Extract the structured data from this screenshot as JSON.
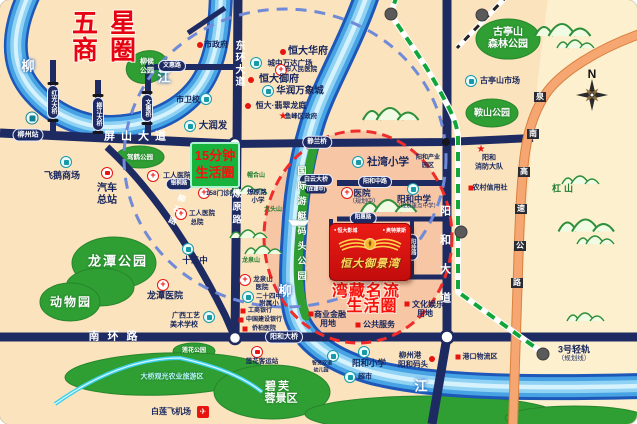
{
  "canvas": {
    "width": 637,
    "height": 424
  },
  "colors": {
    "land": "#fbe3bd",
    "land_east": "#fdf0cf",
    "vip_zone_pink": "#f2ae92",
    "road_navy": "#1e2b63",
    "river_blue": "#47a3e3",
    "park_green": "#2f9e33",
    "highway_orange": "#f5a671",
    "planned_rail_green": "#12a53a",
    "circle_15min_blue": "#6f8ad8",
    "circle_vip_red": "#ef2b2b",
    "accent_red": "#e8140e",
    "gold": "#ffd24a"
  },
  "badges": {
    "life15": {
      "line1": "15分钟",
      "line2": "生活圈"
    },
    "project": {
      "tag_left": "恒大影城",
      "tag_right": "奥特莱斯",
      "name": "恒大御景湾"
    }
  },
  "labels": [
    {
      "id": "biz-circle-title-line1",
      "t": "五星",
      "x": 104,
      "y": 23,
      "c": "title-red"
    },
    {
      "id": "biz-circle-title-line2",
      "t": "商圈",
      "x": 104,
      "y": 50,
      "c": "title-red"
    },
    {
      "id": "river-name-liu-west",
      "t": "柳",
      "x": 28,
      "y": 66,
      "c": "river-ch"
    },
    {
      "id": "river-name-jiang-west",
      "t": "江",
      "x": 164,
      "y": 77,
      "c": "river-ch"
    },
    {
      "id": "river-name-liu-east",
      "t": "柳",
      "x": 285,
      "y": 291,
      "c": "river-ch"
    },
    {
      "id": "river-name-jiang-east",
      "t": "江",
      "x": 421,
      "y": 386,
      "c": "river-ch"
    },
    {
      "id": "city-gov-dot-icon",
      "t": "",
      "x": 200,
      "y": 45,
      "c": "ico-rdot"
    },
    {
      "id": "city-gov",
      "t": "市政府",
      "x": 216,
      "y": 45,
      "c": "poi"
    },
    {
      "id": "wenhui-road-pill",
      "t": "文惠路",
      "x": 172,
      "y": 66,
      "c": "pill",
      "fs": 6
    },
    {
      "id": "liuhou-park-line1",
      "t": "柳侯",
      "x": 147,
      "y": 62,
      "c": "park-ch",
      "fs": 7
    },
    {
      "id": "liuhou-park-line2",
      "t": "公园",
      "x": 147,
      "y": 71,
      "c": "park-ch",
      "fs": 7
    },
    {
      "id": "hongguang-bridge-pill",
      "t": "红光大桥",
      "x": 53,
      "y": 102,
      "c": "pill v bridge",
      "fs": 6
    },
    {
      "id": "liujiang-bridge-pill",
      "t": "柳江大桥",
      "x": 98,
      "y": 114,
      "c": "pill v bridge",
      "fs": 6
    },
    {
      "id": "wenhui-bridge-pill",
      "t": "文惠桥",
      "x": 147,
      "y": 108,
      "c": "pill v bridge",
      "fs": 6
    },
    {
      "id": "health-school",
      "t": "市卫校",
      "x": 188,
      "y": 100,
      "c": "poi"
    },
    {
      "id": "health-school-icon",
      "t": "",
      "x": 206,
      "y": 99,
      "c": "ico-sch"
    },
    {
      "id": "darunfa-icon",
      "t": "",
      "x": 190,
      "y": 126,
      "c": "ico-sch"
    },
    {
      "id": "darunfa",
      "t": "大润发",
      "x": 213,
      "y": 126,
      "c": "poi",
      "fs": 9.5
    },
    {
      "id": "pingshan-avenue",
      "t": "屏山大道",
      "x": 138,
      "y": 137,
      "c": "road-ch",
      "ls": 6
    },
    {
      "id": "donghuan-avenue",
      "t": "东环大道",
      "x": 238,
      "y": 64,
      "c": "road-ch v",
      "fs": 10,
      "ls": 2
    },
    {
      "id": "train-station-icon",
      "t": "",
      "x": 32,
      "y": 118,
      "c": "ico-train"
    },
    {
      "id": "liuzhou-station-pill",
      "t": "柳州站",
      "x": 28,
      "y": 135,
      "c": "pill",
      "fs": 7
    },
    {
      "id": "hengda-huafu-dot-icon",
      "t": "",
      "x": 283,
      "y": 52,
      "c": "ico-rdot"
    },
    {
      "id": "hengda-huafu",
      "t": "恒大华府",
      "x": 308,
      "y": 52,
      "c": "poi",
      "fs": 10
    },
    {
      "id": "wanda-plaza-icon",
      "t": "",
      "x": 256,
      "y": 63,
      "c": "ico-sch"
    },
    {
      "id": "wanda-plaza",
      "t": "城中万达广场",
      "x": 290,
      "y": 63,
      "c": "poi",
      "fs": 7.5
    },
    {
      "id": "renmin-hospital-icon",
      "t": "+",
      "x": 281,
      "y": 70,
      "c": "ico-cross"
    },
    {
      "id": "renmin-hospital",
      "t": "市人民医院",
      "x": 301,
      "y": 70,
      "c": "poi",
      "fs": 6.5
    },
    {
      "id": "hengda-yufu-dot-icon",
      "t": "",
      "x": 251,
      "y": 80,
      "c": "ico-rdot"
    },
    {
      "id": "hengda-yufu",
      "t": "恒大御府",
      "x": 279,
      "y": 80,
      "c": "poi",
      "fs": 10
    },
    {
      "id": "mixc-icon",
      "t": "",
      "x": 268,
      "y": 91,
      "c": "ico-sch"
    },
    {
      "id": "mixc",
      "t": "华润万象城",
      "x": 300,
      "y": 91,
      "c": "poi",
      "fs": 9.5
    },
    {
      "id": "hengda-feicui-dot-icon",
      "t": "",
      "x": 248,
      "y": 106,
      "c": "ico-rdot"
    },
    {
      "id": "hengda-feicui",
      "t": "恒大·翡翠龙庭",
      "x": 281,
      "y": 106,
      "c": "poi"
    },
    {
      "id": "yufeng-gov-star-icon",
      "t": "★",
      "x": 283,
      "y": 117,
      "c": "ico-star"
    },
    {
      "id": "yufeng-gov",
      "t": "鱼峰区政府",
      "x": 301,
      "y": 117,
      "c": "poi",
      "fs": 6.5
    },
    {
      "id": "jiahe-park",
      "t": "驾鹤公园",
      "x": 140,
      "y": 158,
      "c": "park-ch",
      "fs": 6.5
    },
    {
      "id": "feie-mall-icon",
      "t": "",
      "x": 66,
      "y": 162,
      "c": "ico-sch"
    },
    {
      "id": "feie-mall",
      "t": "飞鹅商场",
      "x": 62,
      "y": 176,
      "c": "poi",
      "fs": 9
    },
    {
      "id": "bus-terminal-icon",
      "t": "",
      "x": 107,
      "y": 173,
      "c": "ico-bus"
    },
    {
      "id": "bus-terminal-line1",
      "t": "汽车",
      "x": 107,
      "y": 189,
      "c": "poi",
      "fs": 10
    },
    {
      "id": "bus-terminal-line2",
      "t": "总站",
      "x": 107,
      "y": 201,
      "c": "poi",
      "fs": 10
    },
    {
      "id": "worker-hospital-icon",
      "t": "+",
      "x": 153,
      "y": 176,
      "c": "ico-cross"
    },
    {
      "id": "worker-hospital",
      "t": "工人医院",
      "x": 177,
      "y": 176,
      "c": "poi",
      "fs": 7
    },
    {
      "id": "yintong-road-pill",
      "t": "银桐路",
      "x": 179,
      "y": 184,
      "c": "pill",
      "fs": 5.5
    },
    {
      "id": "clinic158-icon",
      "t": "+",
      "x": 204,
      "y": 193,
      "c": "ico-cross"
    },
    {
      "id": "clinic158",
      "t": "158门诊部",
      "x": 221,
      "y": 194,
      "c": "poi",
      "fs": 6.5
    },
    {
      "id": "worker-hospital-hq-icon",
      "t": "+",
      "x": 181,
      "y": 214,
      "c": "ico-cross"
    },
    {
      "id": "worker-hospital-hq-line1",
      "t": "工人医院",
      "x": 202,
      "y": 214,
      "c": "poi",
      "fs": 6.5
    },
    {
      "id": "worker-hospital-hq-line2",
      "t": "总院",
      "x": 197,
      "y": 223,
      "c": "poi",
      "fs": 6.5
    },
    {
      "id": "liaoyuan-road",
      "t": "燎原路",
      "x": 236,
      "y": 208,
      "c": "road-ch v",
      "fs": 9,
      "ls": 4
    },
    {
      "id": "liushi-road",
      "t": "柳石路",
      "x": 176,
      "y": 211,
      "c": "road-ch v",
      "fs": 8,
      "ls": 4,
      "r": 22
    },
    {
      "id": "liaoyuan-primary-line1",
      "t": "燎原路",
      "x": 257,
      "y": 193,
      "c": "poi",
      "fs": 6.5
    },
    {
      "id": "liaoyuan-primary-line2",
      "t": "小学",
      "x": 258,
      "y": 201,
      "c": "poi",
      "fs": 6.5
    },
    {
      "id": "maohe-hill",
      "t": "帽合山",
      "x": 256,
      "y": 176,
      "c": "mtn-ch",
      "fs": 6
    },
    {
      "id": "jiutou-hill",
      "t": "九头山",
      "x": 273,
      "y": 210,
      "c": "mtn-ch",
      "fs": 6
    },
    {
      "id": "jinglan-bridge-pill",
      "t": "静兰桥",
      "x": 317,
      "y": 142,
      "c": "pill",
      "fs": 6.5
    },
    {
      "id": "shewan-primary-icon",
      "t": "",
      "x": 358,
      "y": 162,
      "c": "ico-sch"
    },
    {
      "id": "shewan-primary",
      "t": "社湾小学",
      "x": 388,
      "y": 162,
      "c": "poi",
      "fs": 10.5
    },
    {
      "id": "yanghe-industry-line1",
      "t": "阳和产业",
      "x": 428,
      "y": 158,
      "c": "poi",
      "fs": 6
    },
    {
      "id": "yanghe-industry-line2",
      "t": "园区",
      "x": 428,
      "y": 166,
      "c": "poi",
      "fs": 6
    },
    {
      "id": "baiyun-bridge-pill",
      "t": "白云大桥",
      "x": 316,
      "y": 180,
      "c": "pill",
      "fs": 6
    },
    {
      "id": "baiyun-bridge-note",
      "t": "(在建中)",
      "x": 316,
      "y": 190,
      "c": "pill-sub"
    },
    {
      "id": "yanghe-mid-road-pill",
      "t": "阳和中路",
      "x": 375,
      "y": 182,
      "c": "pill",
      "fs": 6
    },
    {
      "id": "planned-hospital-icon",
      "t": "+",
      "x": 347,
      "y": 193,
      "c": "ico-cross"
    },
    {
      "id": "planned-hospital",
      "t": "医院",
      "x": 362,
      "y": 193,
      "c": "poi",
      "fs": 8.5
    },
    {
      "id": "planned-hospital-note",
      "t": "（规划中）",
      "x": 364,
      "y": 202,
      "c": "poi-sub"
    },
    {
      "id": "yanghe-middle-school-icon",
      "t": "",
      "x": 413,
      "y": 189,
      "c": "ico-sch"
    },
    {
      "id": "yanghe-middle-school",
      "t": "阳和中学",
      "x": 414,
      "y": 199,
      "c": "poi",
      "fs": 8.5
    },
    {
      "id": "yanghe-middle-school-note",
      "t": "（规划重点中学）",
      "x": 417,
      "y": 207,
      "c": "poi-sub",
      "fs": 5.5
    },
    {
      "id": "yacht-quay-park",
      "t": "国际游艇码头公园",
      "x": 301,
      "y": 226,
      "c": "quay-ch v",
      "ls": 6
    },
    {
      "id": "yanghe-avenue",
      "t": "阳和大道",
      "x": 444,
      "y": 263,
      "c": "road-ch v",
      "ls": 18
    },
    {
      "id": "fire-brigade-star-icon",
      "t": "★",
      "x": 481,
      "y": 150,
      "c": "ico-star"
    },
    {
      "id": "fire-brigade-line1",
      "t": "阳和",
      "x": 489,
      "y": 158,
      "c": "poi",
      "fs": 7
    },
    {
      "id": "fire-brigade-line2",
      "t": "消防大队",
      "x": 489,
      "y": 167,
      "c": "poi",
      "fs": 7
    },
    {
      "id": "rural-credit-sq-icon",
      "t": "",
      "x": 471,
      "y": 188,
      "c": "ico-rsq"
    },
    {
      "id": "rural-credit",
      "t": "农村信用社",
      "x": 490,
      "y": 188,
      "c": "poi",
      "fs": 7
    },
    {
      "id": "gutingshan-forest-line1",
      "t": "古亭山",
      "x": 508,
      "y": 33,
      "c": "park-ch",
      "fs": 10
    },
    {
      "id": "gutingshan-forest-line2",
      "t": "森林公园",
      "x": 508,
      "y": 45,
      "c": "park-ch",
      "fs": 10
    },
    {
      "id": "gutingshan-market-icon",
      "t": "",
      "x": 471,
      "y": 81,
      "c": "ico-sch"
    },
    {
      "id": "gutingshan-market",
      "t": "古亭山市场",
      "x": 500,
      "y": 81,
      "c": "poi"
    },
    {
      "id": "anshan-park",
      "t": "鞍山公园",
      "x": 492,
      "y": 113,
      "c": "park-ch",
      "fs": 9
    },
    {
      "id": "compass-n-label",
      "t": "N",
      "x": 592,
      "y": 74,
      "c": "compass-n"
    },
    {
      "id": "gangshan-hill",
      "t": "杠山",
      "x": 564,
      "y": 189,
      "c": "mtn-ch",
      "fs": 9,
      "ls": 3
    },
    {
      "id": "expressway-ch-1",
      "t": "泉",
      "x": 540,
      "y": 97,
      "c": "hwy-ch"
    },
    {
      "id": "expressway-ch-2",
      "t": "南",
      "x": 533,
      "y": 134,
      "c": "hwy-ch"
    },
    {
      "id": "expressway-ch-3",
      "t": "高",
      "x": 524,
      "y": 172,
      "c": "hwy-ch"
    },
    {
      "id": "expressway-ch-4",
      "t": "速",
      "x": 521,
      "y": 209,
      "c": "hwy-ch"
    },
    {
      "id": "expressway-ch-5",
      "t": "公",
      "x": 520,
      "y": 246,
      "c": "hwy-ch"
    },
    {
      "id": "expressway-ch-6",
      "t": "路",
      "x": 517,
      "y": 283,
      "c": "hwy-ch"
    },
    {
      "id": "yanghui-road-pill",
      "t": "阳惠路",
      "x": 363,
      "y": 218,
      "c": "pill",
      "fs": 5.5
    },
    {
      "id": "yanggui-road-pill",
      "t": "阳桂路",
      "x": 412,
      "y": 247,
      "c": "pill v",
      "fs": 5.5
    },
    {
      "id": "yanggang-road-pill",
      "t": "阳港路",
      "x": 368,
      "y": 276,
      "c": "pill",
      "fs": 5.5
    },
    {
      "id": "vip-circle-line1",
      "t": "湾藏名流",
      "x": 366,
      "y": 292,
      "c": "red-big"
    },
    {
      "id": "vip-circle-line2",
      "t": "生活圈",
      "x": 372,
      "y": 307,
      "c": "red-big"
    },
    {
      "id": "culture-land-sq-icon",
      "t": "",
      "x": 407,
      "y": 304,
      "c": "ico-rsq"
    },
    {
      "id": "culture-land-line1",
      "t": "文化娱乐",
      "x": 428,
      "y": 305,
      "c": "poi"
    },
    {
      "id": "culture-land-line2",
      "t": "用地",
      "x": 425,
      "y": 314,
      "c": "poi"
    },
    {
      "id": "finance-land-sq-icon",
      "t": "",
      "x": 311,
      "y": 314,
      "c": "ico-rsq"
    },
    {
      "id": "finance-land-line1",
      "t": "商业金融",
      "x": 330,
      "y": 315,
      "c": "poi"
    },
    {
      "id": "finance-land-line2",
      "t": "用地",
      "x": 328,
      "y": 324,
      "c": "poi"
    },
    {
      "id": "public-service-sq-icon",
      "t": "",
      "x": 358,
      "y": 325,
      "c": "ico-rsq"
    },
    {
      "id": "public-service",
      "t": "公共服务",
      "x": 379,
      "y": 325,
      "c": "poi"
    },
    {
      "id": "longquanshan-hospital-icon",
      "t": "+",
      "x": 245,
      "y": 280,
      "c": "ico-cross"
    },
    {
      "id": "longquanshan-hospital-line1",
      "t": "龙泉山",
      "x": 263,
      "y": 280,
      "c": "poi",
      "fs": 6.5
    },
    {
      "id": "longquanshan-hospital-line2",
      "t": "医院",
      "x": 262,
      "y": 288,
      "c": "poi",
      "fs": 6.5
    },
    {
      "id": "longquan-hill",
      "t": "龙泉山",
      "x": 251,
      "y": 261,
      "c": "mtn-ch",
      "fs": 6
    },
    {
      "id": "school24-icon",
      "t": "",
      "x": 248,
      "y": 297,
      "c": "ico-sch"
    },
    {
      "id": "school24-line1",
      "t": "二十四中",
      "x": 269,
      "y": 297,
      "c": "poi",
      "fs": 6.5
    },
    {
      "id": "school24-line2",
      "t": "附属小",
      "x": 269,
      "y": 304,
      "c": "poi",
      "fs": 6.5
    },
    {
      "id": "icbc-sq-icon",
      "t": "",
      "x": 243,
      "y": 311,
      "c": "ico-rsq"
    },
    {
      "id": "icbc-bank",
      "t": "工商银行",
      "x": 260,
      "y": 311,
      "c": "poi",
      "fs": 6
    },
    {
      "id": "ccb-sq-icon",
      "t": "",
      "x": 241,
      "y": 320,
      "c": "ico-rsq"
    },
    {
      "id": "ccb-bank",
      "t": "中国建设银行",
      "x": 264,
      "y": 320,
      "c": "poi",
      "fs": 6
    },
    {
      "id": "qiaobai-hospital-sq-icon",
      "t": "",
      "x": 245,
      "y": 329,
      "c": "ico-rsq"
    },
    {
      "id": "qiaobai-hospital",
      "t": "侨柏医院",
      "x": 264,
      "y": 329,
      "c": "poi",
      "fs": 6
    },
    {
      "id": "school13-icon",
      "t": "",
      "x": 188,
      "y": 249,
      "c": "ico-sch"
    },
    {
      "id": "school13",
      "t": "十三中",
      "x": 195,
      "y": 260,
      "c": "poi",
      "fs": 8.5
    },
    {
      "id": "longtan-park",
      "t": "龙潭公园",
      "x": 118,
      "y": 261,
      "c": "park-ch",
      "fs": 13,
      "ls": 2
    },
    {
      "id": "zoo",
      "t": "动物园",
      "x": 71,
      "y": 302,
      "c": "park-ch",
      "fs": 12,
      "ls": 2
    },
    {
      "id": "longtan-hospital-icon",
      "t": "+",
      "x": 163,
      "y": 285,
      "c": "ico-cross"
    },
    {
      "id": "longtan-hospital",
      "t": "龙潭医院",
      "x": 165,
      "y": 296,
      "c": "poi",
      "fs": 9
    },
    {
      "id": "arts-school-line1",
      "t": "广西工艺",
      "x": 186,
      "y": 316,
      "c": "poi",
      "fs": 7
    },
    {
      "id": "arts-school-line2",
      "t": "美术学校",
      "x": 184,
      "y": 325,
      "c": "poi",
      "fs": 7
    },
    {
      "id": "arts-school-icon",
      "t": "",
      "x": 209,
      "y": 317,
      "c": "ico-sch"
    },
    {
      "id": "nanhuan-road",
      "t": "南环路",
      "x": 117,
      "y": 337,
      "c": "road-ch",
      "ls": 8
    },
    {
      "id": "yanghe-bridge-pill",
      "t": "阳和大桥",
      "x": 284,
      "y": 337,
      "c": "pill",
      "fs": 7
    },
    {
      "id": "lianhua-park",
      "t": "莲花公园",
      "x": 194,
      "y": 351,
      "c": "park-ch",
      "fs": 6
    },
    {
      "id": "agri-tourism-zone",
      "t": "大桥观光农业旅游区",
      "x": 172,
      "y": 377,
      "c": "agri-ch"
    },
    {
      "id": "lianhua-station-icon",
      "t": "",
      "x": 257,
      "y": 352,
      "c": "ico-bus"
    },
    {
      "id": "lianhua-station",
      "t": "莲花客运站",
      "x": 262,
      "y": 362,
      "c": "poi",
      "fs": 6.5
    },
    {
      "id": "bifurong-line1",
      "t": "碧芙",
      "x": 278,
      "y": 387,
      "c": "park-ch",
      "fs": 11,
      "ls": 2
    },
    {
      "id": "bifurong-line2",
      "t": "蓉景区",
      "x": 281,
      "y": 399,
      "c": "park-ch",
      "fs": 11
    },
    {
      "id": "bailian-airport",
      "t": "白莲飞机场",
      "x": 171,
      "y": 412,
      "c": "poi"
    },
    {
      "id": "bailian-airport-icon",
      "t": "✈",
      "x": 203,
      "y": 412,
      "c": "ico-plane"
    },
    {
      "id": "kindergarten-icon",
      "t": "",
      "x": 333,
      "y": 356,
      "c": "ico-sch"
    },
    {
      "id": "kindergarten-line1",
      "t": "智贤双语",
      "x": 322,
      "y": 364,
      "c": "poi",
      "fs": 5
    },
    {
      "id": "kindergarten-line2",
      "t": "幼儿园",
      "x": 321,
      "y": 371,
      "c": "poi",
      "fs": 5
    },
    {
      "id": "yanghe-primary-icon",
      "t": "",
      "x": 364,
      "y": 352,
      "c": "ico-sch"
    },
    {
      "id": "yanghe-primary",
      "t": "阳和小学",
      "x": 369,
      "y": 363,
      "c": "poi",
      "fs": 8.5
    },
    {
      "id": "supermarket-icon",
      "t": "",
      "x": 350,
      "y": 377,
      "c": "ico-sch"
    },
    {
      "id": "supermarket",
      "t": "超市",
      "x": 365,
      "y": 377,
      "c": "poi",
      "fs": 7
    },
    {
      "id": "port-wharf-line1",
      "t": "柳州港",
      "x": 410,
      "y": 355,
      "c": "poi",
      "fs": 7.5
    },
    {
      "id": "port-wharf-line2",
      "t": "阳和码头",
      "x": 413,
      "y": 364,
      "c": "poi",
      "fs": 7.5
    },
    {
      "id": "port-wharf-dot-icon",
      "t": "",
      "x": 432,
      "y": 359,
      "c": "ico-rdot"
    },
    {
      "id": "port-logistics-sq-icon",
      "t": "",
      "x": 458,
      "y": 357,
      "c": "ico-rsq"
    },
    {
      "id": "port-logistics",
      "t": "港口物流区",
      "x": 480,
      "y": 357,
      "c": "poi",
      "fs": 7
    },
    {
      "id": "rail3-label",
      "t": "3号轻轨",
      "x": 574,
      "y": 350,
      "c": "poi",
      "fs": 9
    },
    {
      "id": "rail3-note",
      "t": "（规划线）",
      "x": 574,
      "y": 359,
      "c": "poi-sub",
      "fs": 6.5
    },
    {
      "id": "rail3-station-dot",
      "t": "",
      "x": 543,
      "y": 354,
      "c": "sta-dot"
    },
    {
      "id": "rail-station-dot-mid",
      "t": "",
      "x": 461,
      "y": 232,
      "c": "sta-dot"
    },
    {
      "id": "rail-station-dot-top",
      "t": "",
      "x": 391,
      "y": 14,
      "c": "sta-dot"
    },
    {
      "id": "rail-station-dot-topright",
      "t": "",
      "x": 482,
      "y": 15,
      "c": "sta-dot"
    }
  ]
}
